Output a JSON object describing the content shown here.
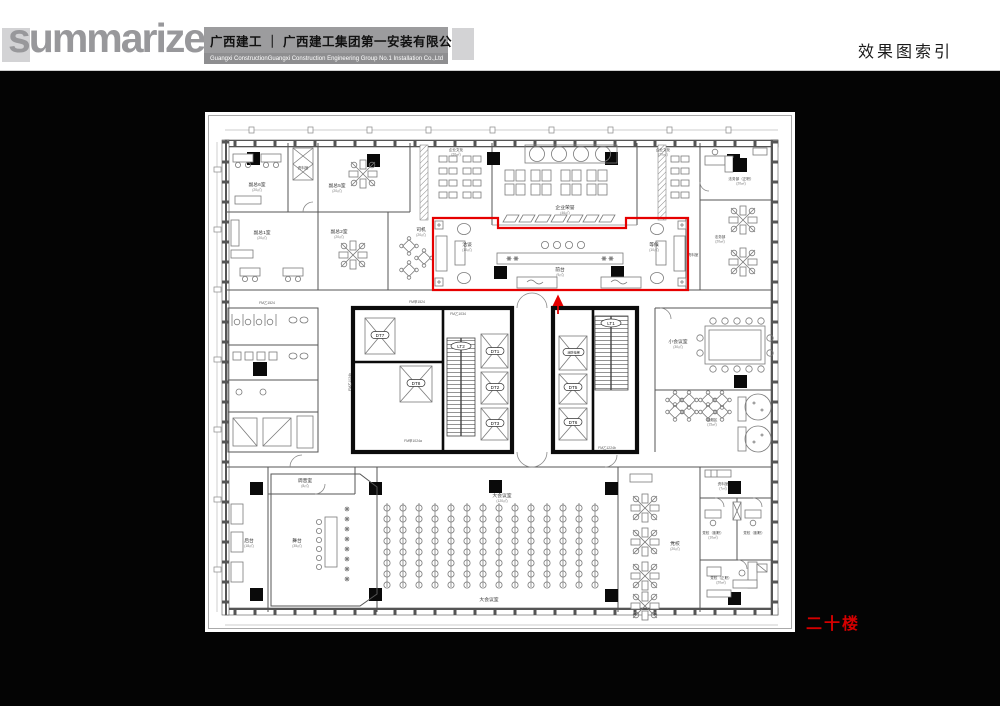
{
  "header": {
    "logo": "summarize",
    "company_cn": "广西建工 ｜ 广西建工集团第一安装有限公司",
    "company_en_left": "Guangxi Construction",
    "company_en_right": "Guangxi Construction Engineering Group No.1 Installation Co.,Ltd",
    "page_title": "效果图索引"
  },
  "floor_tag": "二十楼",
  "plan": {
    "rooms": {
      "fz6": {
        "name": "副总6室",
        "area": "(20㎡)"
      },
      "ziliao1": {
        "name": "资料室",
        "area": "(7㎡)"
      },
      "fz5": {
        "name": "副总5室",
        "area": "(20㎡)"
      },
      "fz1": {
        "name": "副总1室",
        "area": "(20㎡)"
      },
      "fz2": {
        "name": "副总2室",
        "area": "(20㎡)"
      },
      "siji": {
        "name": "司机",
        "area": "(20㎡)"
      },
      "qywh_l": {
        "name": "企业文化",
        "area": "(20㎡)"
      },
      "qyry": {
        "name": "企业荣誉",
        "area": "(46㎡)"
      },
      "qywh_r": {
        "name": "企业文化",
        "area": "(20㎡)"
      },
      "fwb_z": {
        "name": "法务部（正职）",
        "area": "(20㎡)"
      },
      "fwb": {
        "name": "法务部",
        "area": "(20㎡)"
      },
      "ziliao2": {
        "name": "资料室",
        "area": ""
      },
      "qiatan": {
        "name": "洽谈",
        "area": "(10㎡)"
      },
      "qiantai": {
        "name": "前台",
        "area": "(9㎡)"
      },
      "denghou": {
        "name": "等候",
        "area": "(10㎡)"
      },
      "xhys": {
        "name": "小会议室",
        "area": "(30㎡)"
      },
      "xyq": {
        "name": "吸烟区",
        "area": "(15㎡)"
      },
      "tys": {
        "name": "调音室",
        "area": "(8㎡)"
      },
      "houtai": {
        "name": "后台",
        "area": "(18㎡)"
      },
      "wutai": {
        "name": "舞台",
        "area": "(35㎡)"
      },
      "dhys": {
        "name": "大会议室",
        "area": "(120㎡)"
      },
      "dx": {
        "name": "党校",
        "area": "(20㎡)"
      },
      "ziliao3": {
        "name": "资料室",
        "area": "(7㎡)"
      },
      "dx_f": {
        "name": "党校（副职）",
        "area": "(10㎡)"
      },
      "dx_z": {
        "name": "党校（正职）",
        "area": "(20㎡)"
      }
    },
    "elevators": {
      "dt1": "DT1",
      "dt2": "DT2",
      "dt3": "DT3",
      "dt5": "DT5",
      "dt6": "DT6",
      "dt7": "DT7",
      "dt8": "DT8",
      "xfdt": "消防电梯",
      "lt1": "LT1",
      "lt2": "LT2"
    },
    "door_codes": {
      "fm1": "FM甲1524",
      "fm2": "FM乙1034",
      "fm3": "FM乙1024b",
      "fm4": "FM甲1024a",
      "fm5": "FM乙1224b",
      "fm6": "FM乙1524"
    }
  }
}
